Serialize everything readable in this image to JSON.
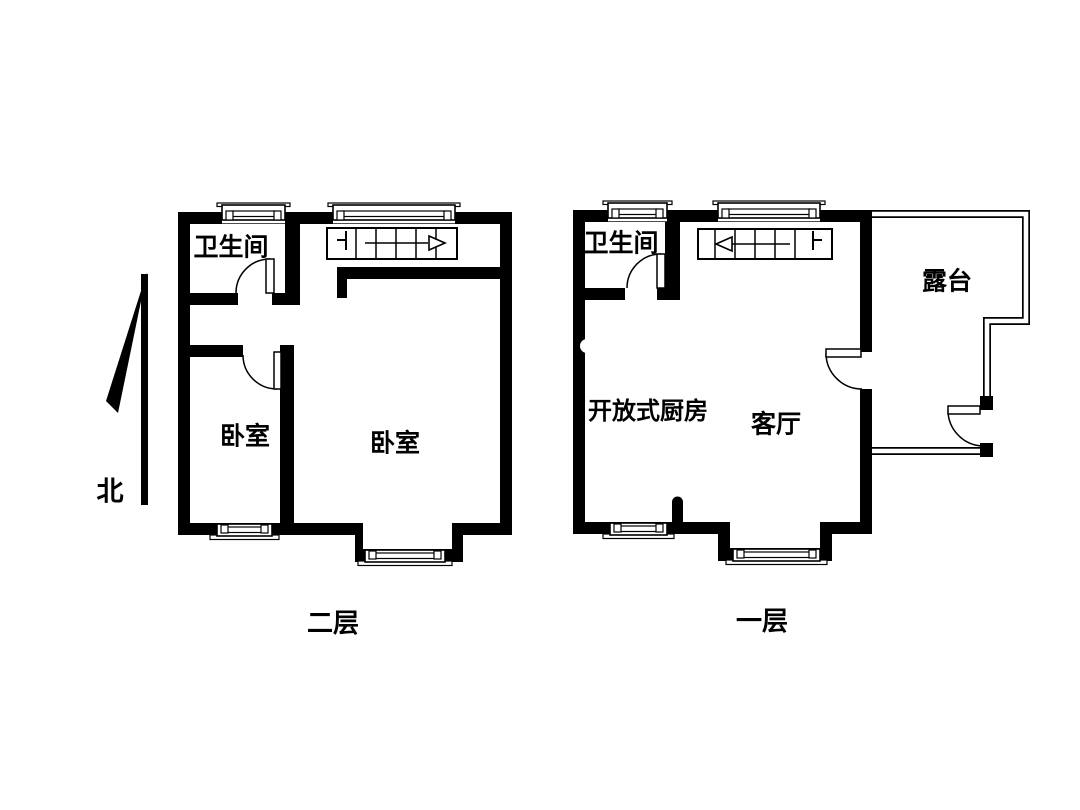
{
  "page": {
    "width": 1080,
    "height": 810,
    "background": "#ffffff",
    "ink": "#000000"
  },
  "north_indicator": {
    "label": "北",
    "label_pos": [
      110,
      492
    ],
    "label_size": 27,
    "shaft": [
      141,
      274,
      7,
      231
    ],
    "wedge": [
      [
        147,
        272
      ],
      [
        106,
        401
      ],
      [
        118,
        413
      ]
    ]
  },
  "floors": [
    {
      "id": "second-floor",
      "caption": "二层",
      "caption_pos": [
        333,
        624
      ],
      "caption_size": 26,
      "room_labels": [
        {
          "name": "bathroom",
          "label": "卫生间",
          "pos": [
            231,
            247
          ],
          "size": 25
        },
        {
          "name": "bedroom-small",
          "label": "卧室",
          "pos": [
            245,
            436
          ],
          "size": 25
        },
        {
          "name": "bedroom-large",
          "label": "卧室",
          "pos": [
            395,
            443
          ],
          "size": 25
        }
      ],
      "walls": [
        {
          "name": "outer-top-wall",
          "r": [
            178,
            212,
            334,
            12
          ]
        },
        {
          "name": "outer-left-wall",
          "r": [
            178,
            212,
            12,
            323
          ]
        },
        {
          "name": "outer-right-wall",
          "r": [
            500,
            212,
            12,
            323
          ]
        },
        {
          "name": "outer-bottom-wall-left",
          "r": [
            178,
            523,
            185,
            12
          ]
        },
        {
          "name": "bay-left-wall",
          "r": [
            355,
            523,
            8,
            39
          ]
        },
        {
          "name": "bay-bottom-wall",
          "r": [
            355,
            549,
            108,
            13
          ]
        },
        {
          "name": "bay-right-wall",
          "r": [
            452,
            523,
            11,
            39
          ]
        },
        {
          "name": "outer-bottom-wall-right",
          "r": [
            452,
            523,
            60,
            12
          ]
        },
        {
          "name": "bathroom-right-wall",
          "r": [
            285,
            224,
            15,
            81
          ]
        },
        {
          "name": "bathroom-bottom-wall",
          "r": [
            190,
            293,
            48,
            12
          ]
        },
        {
          "name": "bathroom-hinge-stub",
          "r": [
            272,
            293,
            28,
            12
          ]
        },
        {
          "name": "bedroom-small-top-wall",
          "r": [
            190,
            345,
            53,
            12
          ]
        },
        {
          "name": "bedroom-divider-wall",
          "r": [
            280,
            345,
            14,
            178
          ]
        },
        {
          "name": "bedroom-large-top-wall",
          "r": [
            337,
            267,
            175,
            12
          ]
        },
        {
          "name": "stair-side-stub",
          "r": [
            337,
            267,
            10,
            31
          ]
        }
      ],
      "windows": [
        {
          "name": "window-bathroom-top",
          "x": 222,
          "w": 63,
          "wall_y": 212,
          "side": "top"
        },
        {
          "name": "window-stairs-top",
          "x": 333,
          "w": 122,
          "wall_y": 212,
          "side": "top"
        },
        {
          "name": "window-bedroom-small-bottom",
          "x": 217,
          "w": 55,
          "wall_y": 523,
          "side": "bottom"
        },
        {
          "name": "window-bay-bottom",
          "x": 365,
          "w": 80,
          "wall_y": 549,
          "side": "bottom"
        }
      ],
      "doors": [
        {
          "name": "bathroom-door",
          "leaf": [
            266,
            259,
            8,
            34
          ],
          "arc": "M270,259 A34,34 0 0 0 236,293"
        },
        {
          "name": "bedroom-small-door",
          "leaf": [
            274,
            352,
            7,
            37
          ],
          "arc": "M243,355 A34,34 0 0 0 277,389"
        }
      ],
      "stairs": {
        "x": 327,
        "y": 228,
        "w": 130,
        "h": 31,
        "dividers": [
          356,
          376,
          396,
          416,
          436
        ],
        "arrow_line": [
          365,
          243,
          428,
          243
        ],
        "arrow_head": [
          [
            445,
            243
          ],
          [
            429,
            236
          ],
          [
            429,
            250
          ]
        ],
        "marker": [
          [
            337,
            240,
            346,
            240
          ],
          [
            346,
            231,
            346,
            250
          ]
        ]
      }
    },
    {
      "id": "first-floor",
      "caption": "一层",
      "caption_pos": [
        762,
        622
      ],
      "caption_size": 26,
      "room_labels": [
        {
          "name": "bathroom",
          "label": "卫生间",
          "pos": [
            621,
            243
          ],
          "size": 25
        },
        {
          "name": "open-kitchen",
          "label": "开放式厨房",
          "pos": [
            648,
            411
          ],
          "size": 24
        },
        {
          "name": "living-room",
          "label": "客厅",
          "pos": [
            776,
            424
          ],
          "size": 25
        },
        {
          "name": "terrace",
          "label": "露台",
          "pos": [
            947,
            281
          ],
          "size": 25
        }
      ],
      "walls": [
        {
          "name": "outer-top-wall",
          "r": [
            573,
            210,
            299,
            12
          ]
        },
        {
          "name": "outer-left-wall",
          "r": [
            573,
            210,
            12,
            324
          ]
        },
        {
          "name": "outer-right-wall-upper",
          "r": [
            860,
            210,
            12,
            142
          ]
        },
        {
          "name": "outer-right-wall-lower",
          "r": [
            860,
            389,
            12,
            145
          ]
        },
        {
          "name": "outer-bottom-wall-left",
          "r": [
            573,
            522,
            157,
            12
          ]
        },
        {
          "name": "bay-left-wall",
          "r": [
            718,
            522,
            12,
            39
          ]
        },
        {
          "name": "bay-bottom-wall",
          "r": [
            718,
            548,
            114,
            13
          ]
        },
        {
          "name": "bay-right-wall",
          "r": [
            820,
            522,
            12,
            39
          ]
        },
        {
          "name": "outer-bottom-wall-right",
          "r": [
            820,
            522,
            52,
            12
          ]
        },
        {
          "name": "bathroom-right-wall",
          "r": [
            665,
            222,
            15,
            78
          ]
        },
        {
          "name": "bathroom-bottom-wall",
          "r": [
            585,
            288,
            40,
            12
          ]
        },
        {
          "name": "bathroom-hinge-stub",
          "r": [
            657,
            288,
            23,
            12
          ]
        }
      ],
      "kitchen_stub": {
        "x": 672,
        "top": 502,
        "w": 11,
        "bottom": 534,
        "radius": 5.5
      },
      "wall_notch": {
        "cx": 587,
        "cy": 346,
        "r": 7
      },
      "windows": [
        {
          "name": "window-bathroom-top",
          "x": 608,
          "w": 59,
          "wall_y": 210,
          "side": "top"
        },
        {
          "name": "window-stairs-top",
          "x": 718,
          "w": 102,
          "wall_y": 210,
          "side": "top"
        },
        {
          "name": "window-kitchen-bottom",
          "x": 610,
          "w": 57,
          "wall_y": 522,
          "side": "bottom"
        },
        {
          "name": "window-bay-bottom",
          "x": 733,
          "w": 87,
          "wall_y": 548,
          "side": "bottom"
        }
      ],
      "doors": [
        {
          "name": "bathroom-door",
          "leaf": [
            657,
            254,
            8,
            34
          ],
          "arc": "M661,254 A34,34 0 0 0 627,288"
        },
        {
          "name": "terrace-door",
          "leaf": [
            826,
            349,
            35,
            8
          ],
          "arc": "M826,353 A36,36 0 0 0 862,389"
        }
      ],
      "stairs": {
        "x": 698,
        "y": 229,
        "w": 134,
        "h": 30,
        "dividers": [
          715,
          735,
          755,
          775,
          795
        ],
        "arrow_line": [
          730,
          244,
          790,
          244
        ],
        "arrow_head": [
          [
            716,
            244
          ],
          [
            732,
            237
          ],
          [
            732,
            251
          ]
        ],
        "marker": [
          [
            813,
            240,
            822,
            240
          ],
          [
            813,
            231,
            813,
            250
          ]
        ]
      },
      "terrace": {
        "outline": [
          [
            872,
            214
          ],
          [
            1026,
            214
          ],
          [
            1026,
            321
          ],
          [
            987,
            321
          ],
          [
            987,
            398
          ]
        ],
        "bottom": [
          [
            989,
            451
          ],
          [
            872,
            451
          ]
        ],
        "jamb_blocks": [
          [
            980,
            396,
            13,
            14
          ],
          [
            980,
            443,
            13,
            14
          ]
        ],
        "door_leaf": [
          948,
          406,
          32,
          8
        ],
        "door_arc": "M948,410 A36,36 0 0 0 982,446"
      }
    }
  ]
}
